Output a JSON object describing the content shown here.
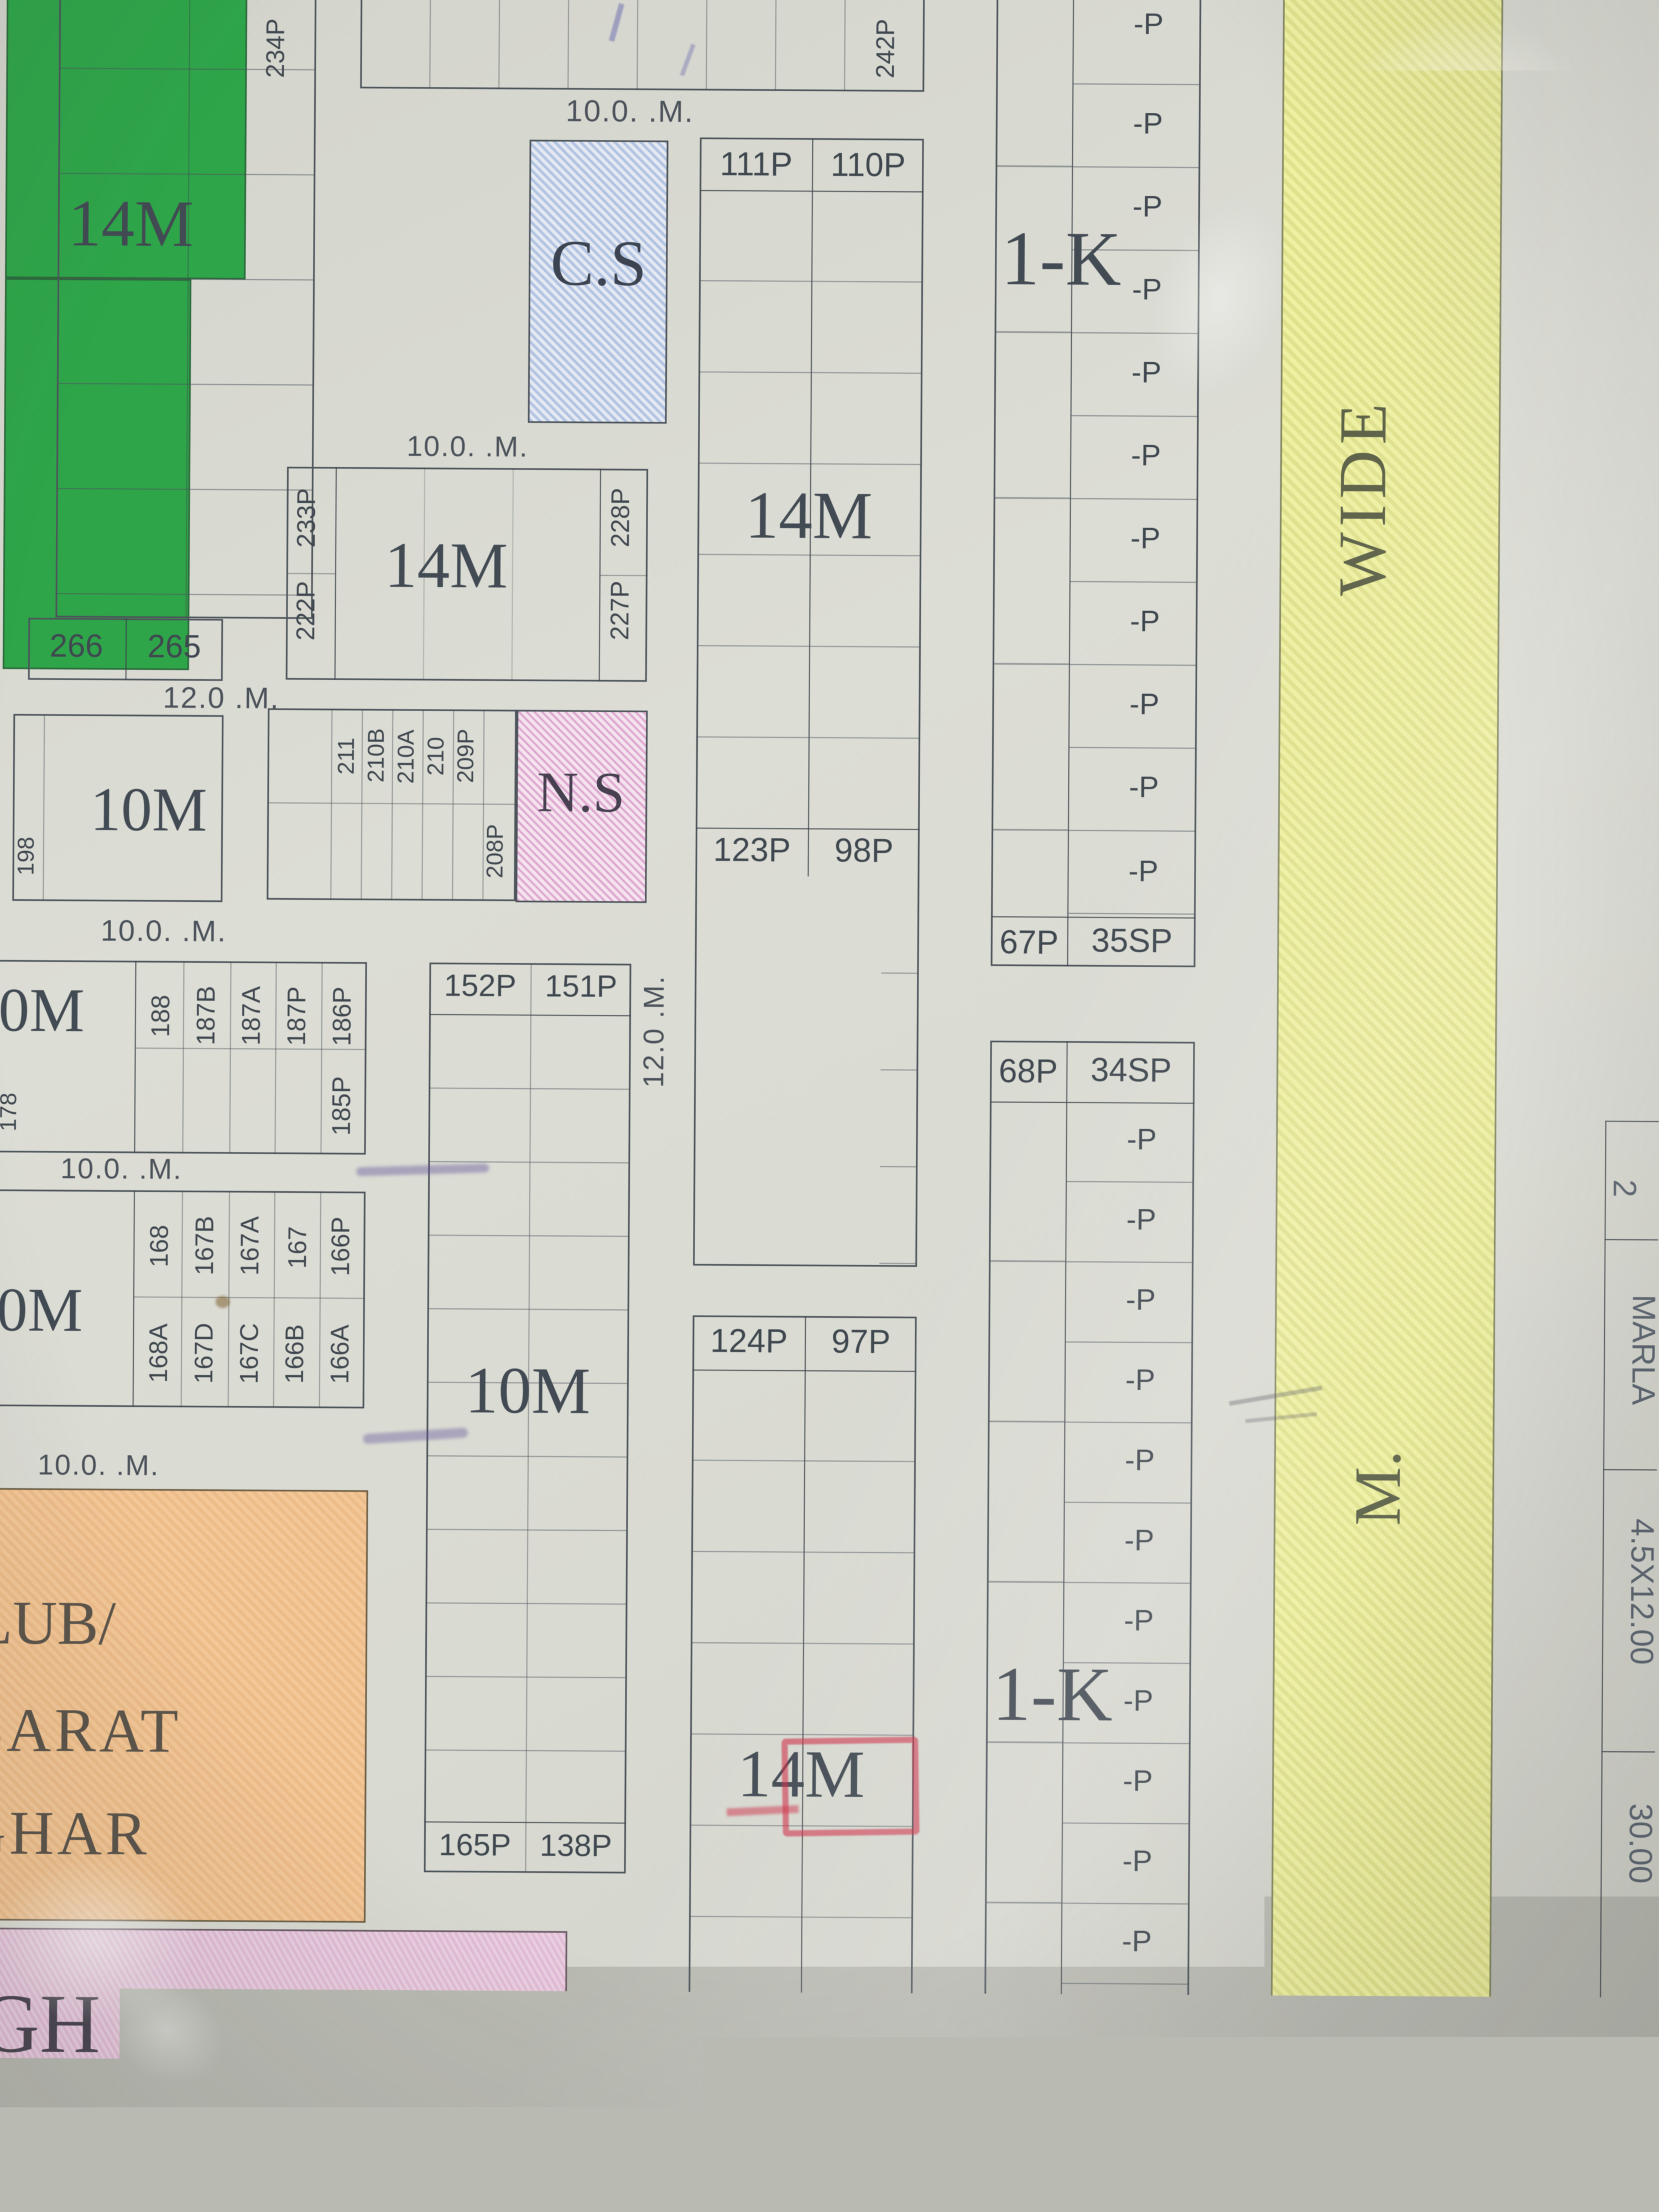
{
  "zones": {
    "m14": "14M",
    "m10": "10M",
    "m10_cut": "0M",
    "k1": "1-K",
    "cs": "C.S",
    "ns": "N.S",
    "wide": "WIDE",
    "m_label": "M.",
    "club_line1": "LUB/",
    "club_line2": "BARAT",
    "club_line3": "GHAR",
    "gh": "GH",
    "school": "SCHOOL"
  },
  "roads": {
    "h10": "10.0. .M.",
    "h12": "12.0 .M.",
    "v12_upper": "12.0 .M.",
    "v12_lower": "12.0. .M."
  },
  "plots": {
    "p": "-P",
    "top_left_rot": "234P",
    "top_right_rot": "242P",
    "row266": [
      "266",
      "265"
    ],
    "block14m_side": [
      "233P",
      "222P",
      "228P",
      "227P"
    ],
    "strip210": [
      "211",
      "210B",
      "210A",
      "210",
      "209P",
      "208P"
    ],
    "strip188": [
      "188",
      "187B",
      "187A",
      "187P",
      "186P",
      "185P"
    ],
    "strip168_top": [
      "168",
      "167B",
      "167A",
      "167",
      "166P"
    ],
    "strip168_bottom": [
      "168A",
      "167D",
      "167C",
      "166B",
      "166A"
    ],
    "edge": [
      "198",
      "178"
    ],
    "mid_upper": [
      "111P",
      "110P",
      "123P",
      "98P"
    ],
    "mid_lower": [
      "124P",
      "97P",
      "137P",
      "84P"
    ],
    "tall10m": [
      "152P",
      "151P",
      "165P",
      "138P"
    ],
    "right_upper": [
      "67P",
      "35SP"
    ],
    "right_lower": [
      "68P",
      "34SP",
      "83P",
      "19SP"
    ]
  },
  "side_table": {
    "c1": "2",
    "c2": "MARLA",
    "c3": "4.5X12.00",
    "c4": "30.00",
    "edge": "ENH"
  },
  "colors": {
    "park_green": "#2fa54a",
    "cs_blue": "#b3c4e2",
    "ns_pink": "#e0a9d0",
    "road_yellow": "#eef0a2",
    "club_orange": "#f3c797",
    "school_pink": "#e9cfe0",
    "annotation_red": "#cf2f4e",
    "paper": "#d9dad2"
  }
}
